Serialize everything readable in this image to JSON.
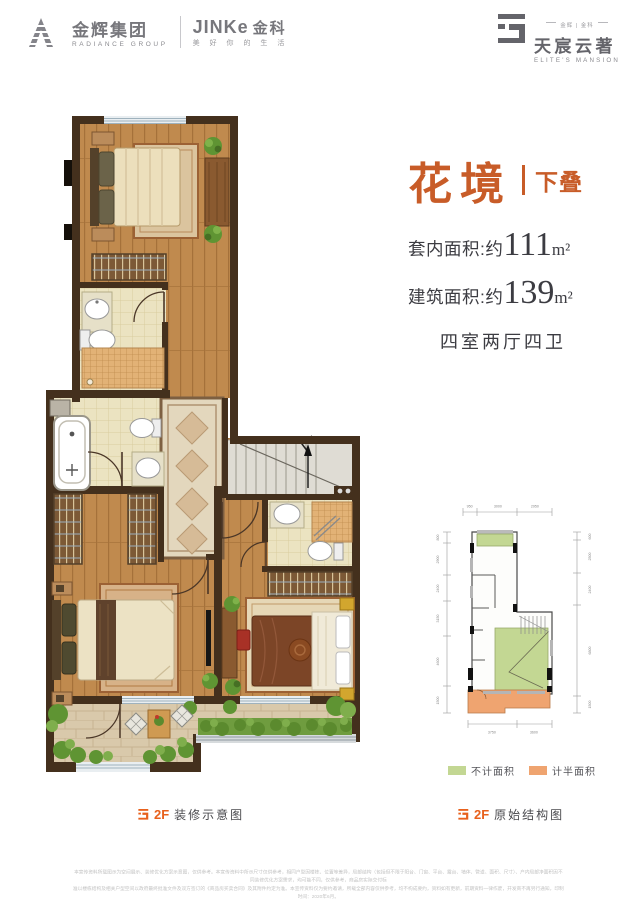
{
  "header": {
    "radiance_cn": "金辉集团",
    "radiance_en": "RADIANCE GROUP",
    "jinke_brand": "JINKe",
    "jinke_cn": "金科",
    "jinke_slogan": "美 好 你 的 生 活",
    "estate_tagline": "金辉 | 金科",
    "estate_cn": "天宸云著",
    "estate_en": "ELITE'S MANSION"
  },
  "info": {
    "title": "花境",
    "subtitle": "下叠",
    "area1_label": "套内面积:约",
    "area1_value": "111",
    "area1_unit": "m²",
    "area2_label": "建筑面积:约",
    "area2_value": "139",
    "area2_unit": "m²",
    "layout": "四室两厅四卫"
  },
  "captions": {
    "main_floor": "2F",
    "main_text": "装修示意图",
    "struct_floor": "2F",
    "struct_text": "原始结构图"
  },
  "legend": {
    "no_area": "不计面积",
    "half_area": "计半面积"
  },
  "structural": {
    "dims_top": [
      "950",
      "3000",
      "2950"
    ],
    "dims_left": [
      "800",
      "2900",
      "2400",
      "3150",
      "4600",
      "1500"
    ],
    "dims_right": [
      "600",
      "2500",
      "2400",
      "6800",
      "1500"
    ],
    "dims_bottom": [
      "3750",
      "3600"
    ]
  },
  "disclaimer": {
    "line1": "本宣传资料所载图示为空间展示、装修优化方案示意图，仅供参考。本宣传资料中所示尺寸仅供参考，相同户型因楼栋、位置等差异，局部结构（包括但不限于阳台、门窗、平台、露台、墙体、管道、面积、尺寸）、户内局部净面积因不同装修优化方案需求，均可能不同，仅供参考，商品房实际交付标",
    "line2": "准以楼栋结构及相关户型空间以政府最终批准文件及双方签订的《商品房买卖合同》及其附件约定为准。本宣传资料仅为要约邀请，所载全部内容仅供参考，均不构成要约，资料如有更新，前期资料一律作废，开发商不再另行通知，印制时间：2020年6月。"
  },
  "colors": {
    "accent_orange": "#cf5a26",
    "legend_green": "#c3d793",
    "legend_orange": "#efa470",
    "wall_brown": "#44301d",
    "wood_floor": "#c08a4e"
  }
}
